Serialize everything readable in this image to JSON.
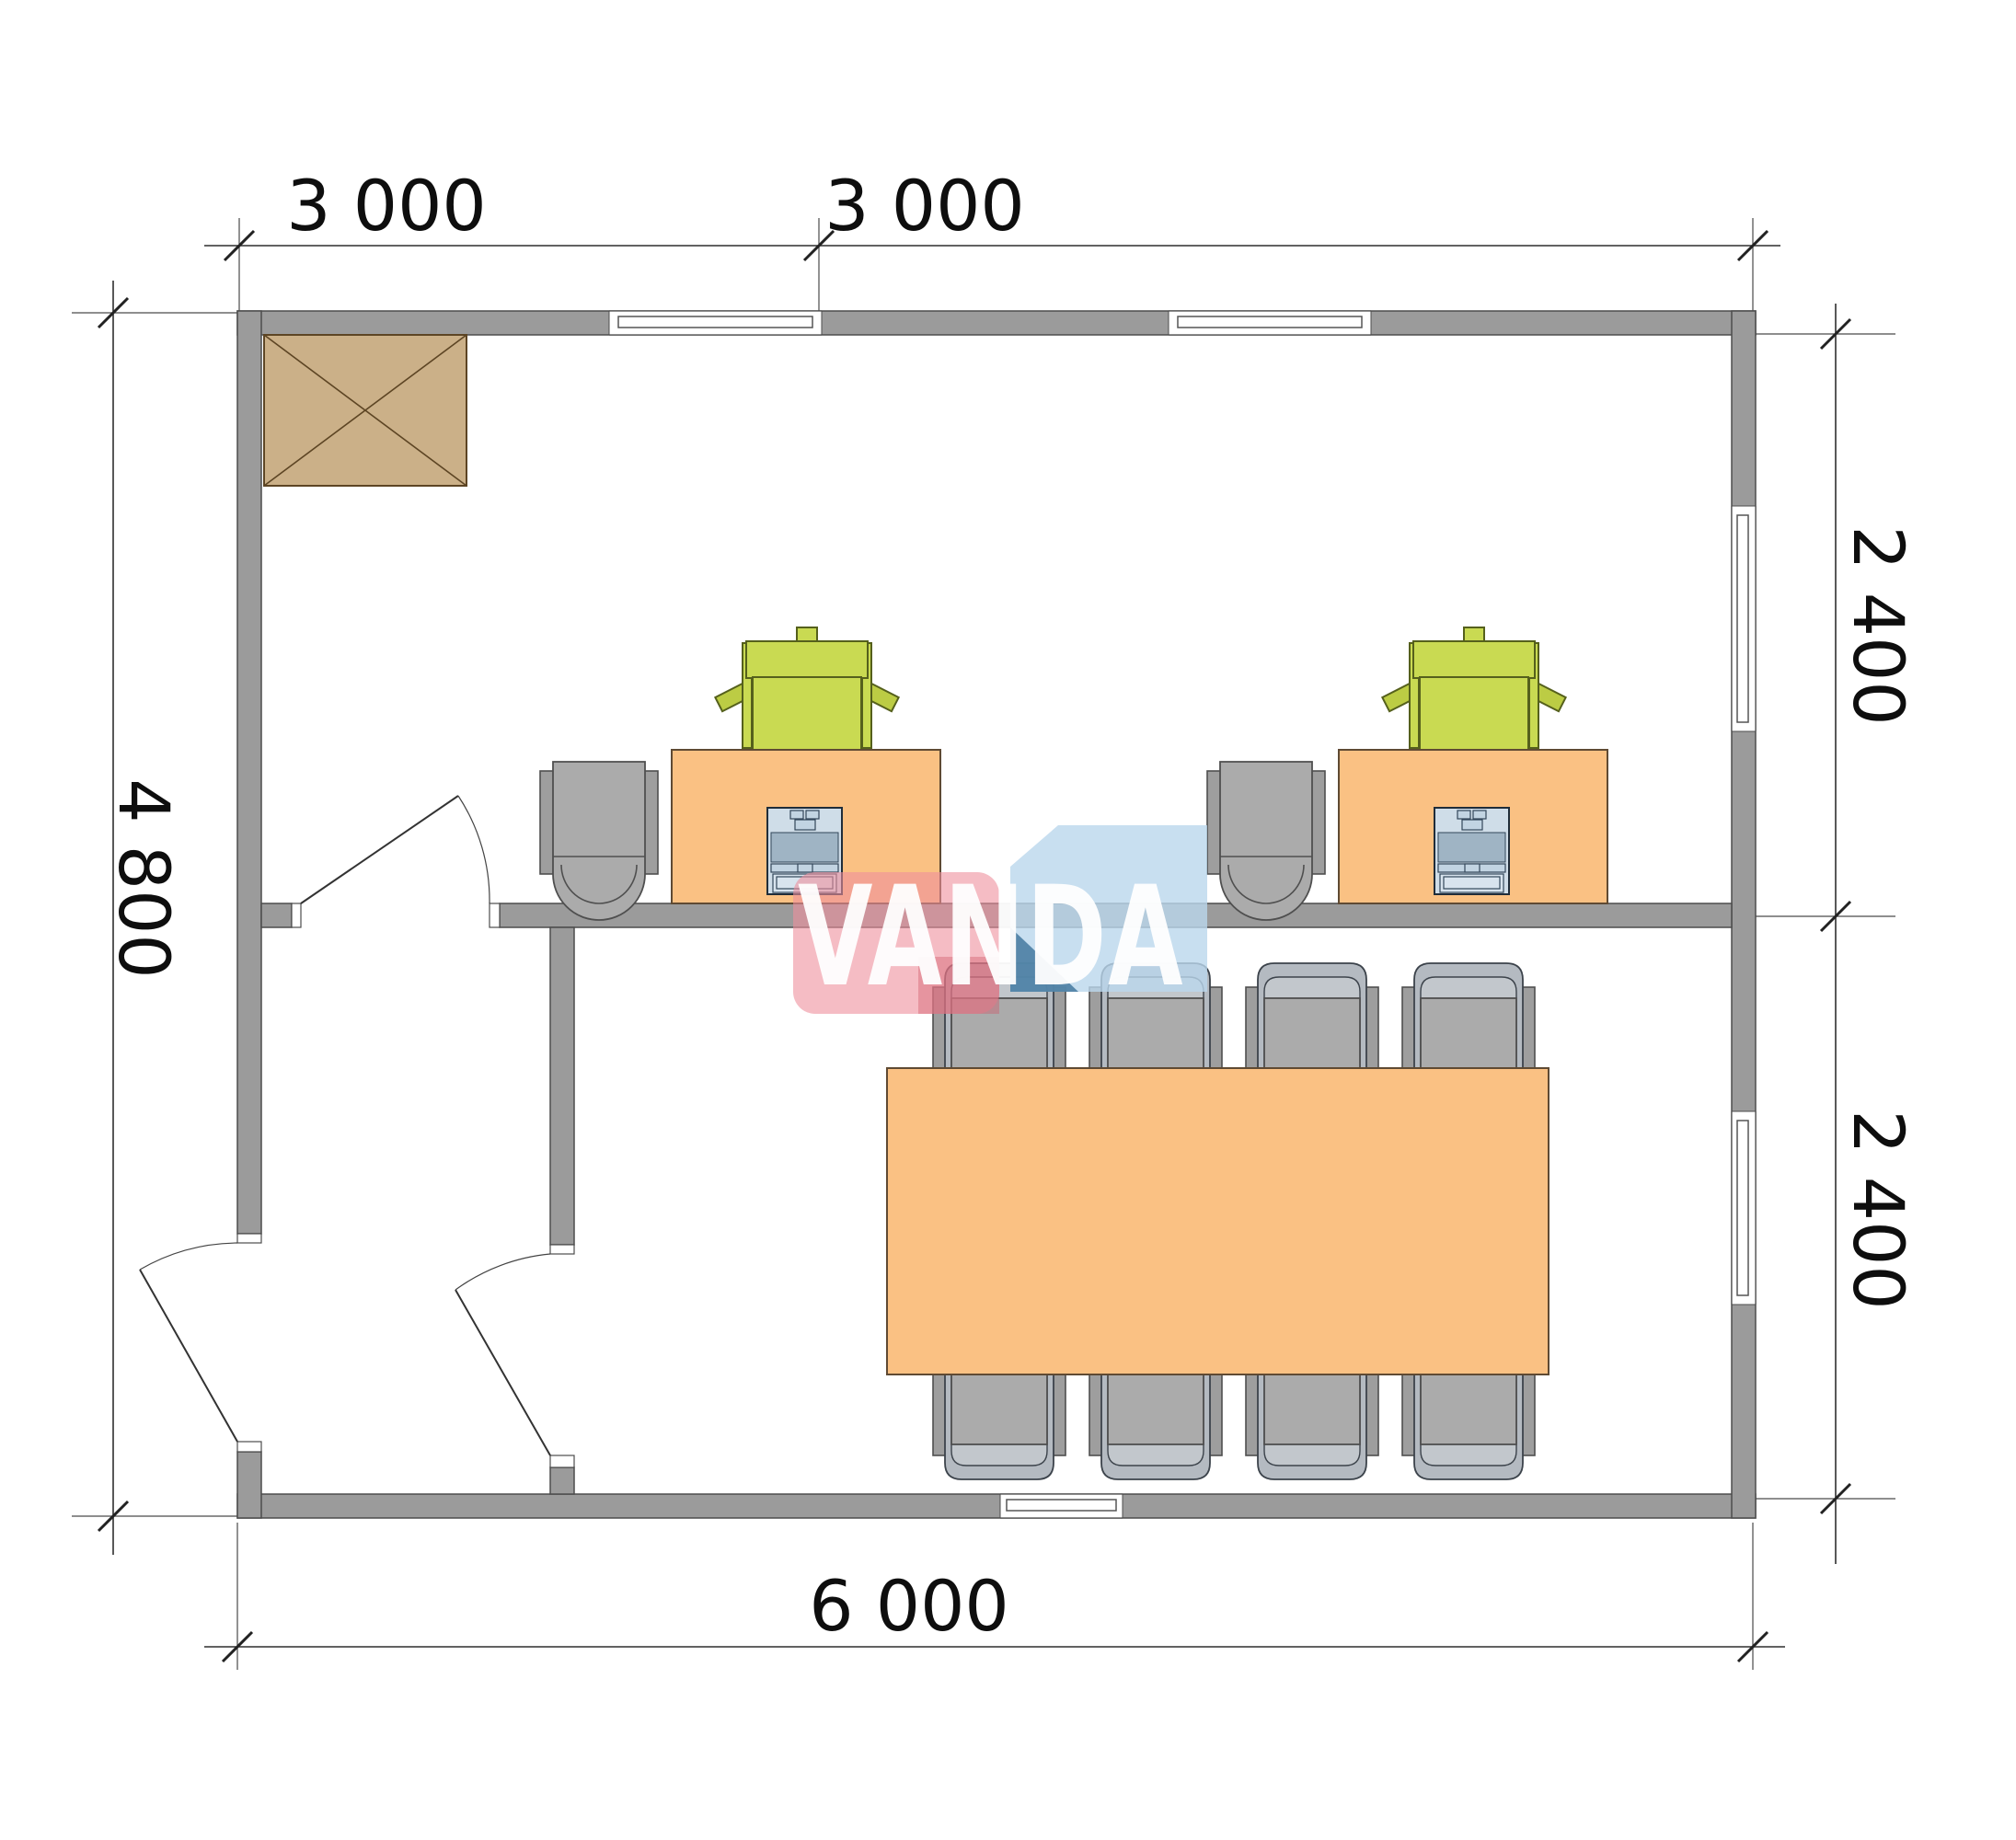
{
  "floor_plan": {
    "dimensions": {
      "top": [
        "3 000",
        "3 000"
      ],
      "left": "4 800",
      "right": [
        "2 400",
        "2 400"
      ],
      "bottom": "6 000"
    },
    "watermark": {
      "text": "VANDA"
    },
    "colors": {
      "wall": "#9b9b9b",
      "wall_outline": "#4d4d4d",
      "desk_and_table": "#fac183",
      "office_chair_green": "#c9da52",
      "chair_gray": "#ababab",
      "crossed_hatch_box": "#cbb088",
      "laptop_body": "#cfdde8",
      "logo_pink": "#ee8f9c",
      "logo_blue": "#bad7ec",
      "logo_blue_dark": "#44799f",
      "logo_text": "#ffffff",
      "dimension_text": "#0e0e0e"
    }
  }
}
